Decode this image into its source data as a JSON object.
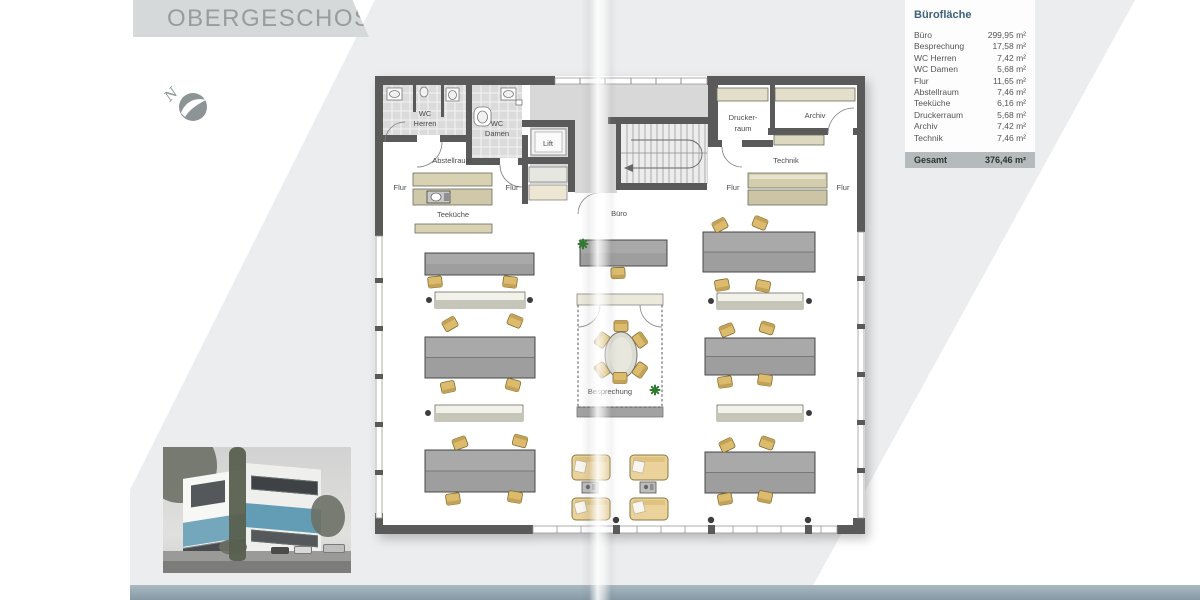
{
  "page": {
    "title": "OBERGESCHOSS"
  },
  "compass": {
    "label": "N"
  },
  "legend": {
    "title": "Bürofläche",
    "rows": [
      {
        "name": "Büro",
        "area": "299,95 m²"
      },
      {
        "name": "Besprechung",
        "area": "17,58 m²"
      },
      {
        "name": "WC Herren",
        "area": "7,42 m²"
      },
      {
        "name": "WC Damen",
        "area": "5,68 m²"
      },
      {
        "name": "Flur",
        "area": "11,65 m²"
      },
      {
        "name": "Abstellraum",
        "area": "7,46 m²"
      },
      {
        "name": "Teeküche",
        "area": "6,16 m²"
      },
      {
        "name": "Druckerraum",
        "area": "5,68 m²"
      },
      {
        "name": "Archiv",
        "area": "7,42 m²"
      },
      {
        "name": "Technik",
        "area": "7,46 m²"
      }
    ],
    "total_label": "Gesamt",
    "total_value": "376,46 m²"
  },
  "plan": {
    "labels": {
      "wc1": "WC",
      "wc_herren": "Herren",
      "wc2": "WC",
      "wc_damen": "Damen",
      "lift": "Lift",
      "abstellraum": "Abstellraum",
      "flur": "Flur",
      "teekueche": "Teeküche",
      "buero": "Büro",
      "drucker_line1": "Drucker-",
      "drucker_line2": "raum",
      "archiv": "Archiv",
      "technik": "Technik",
      "besprechung": "Besprechung"
    }
  },
  "colors": {
    "accent_blue_band": "#6f9fb8",
    "band_bottom": "#8fa2ae",
    "legend_title": "#3c6377"
  }
}
